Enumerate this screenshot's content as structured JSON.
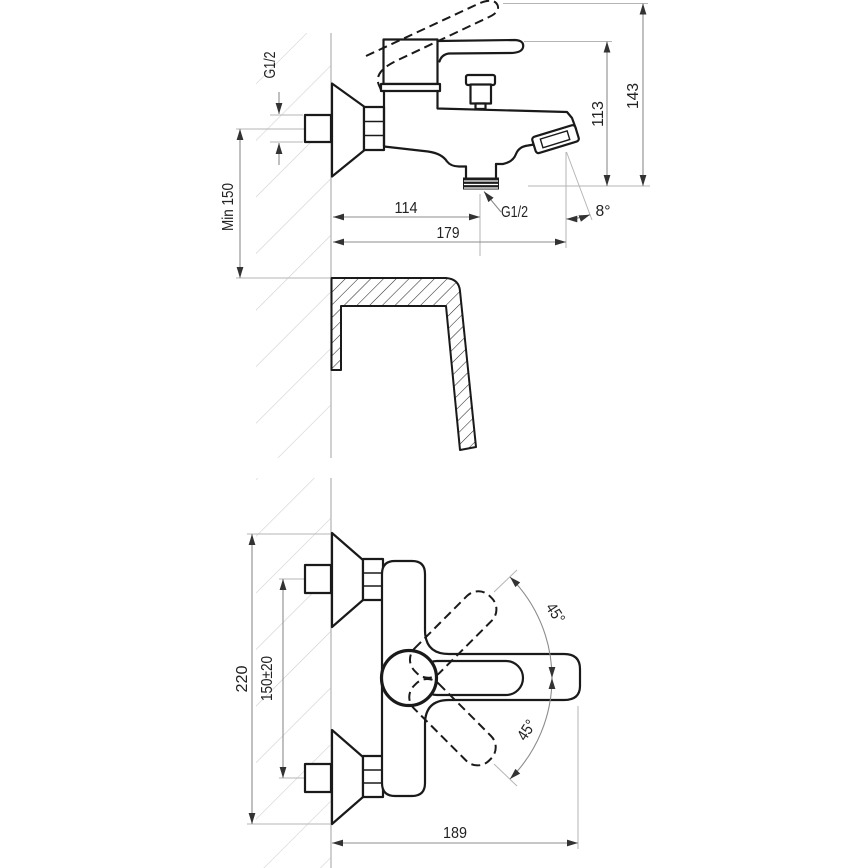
{
  "title": "Wall-mounted bath mixer dimensional drawing",
  "views": {
    "side": {
      "inlet_thread_label": "G1/2",
      "min_mount_height": "Min 150",
      "wall_to_shower_outlet": "114",
      "wall_to_spout_end": "179",
      "shower_outlet_thread": "G1/2",
      "spout_tilt_angle": "8°",
      "spout_height": "113",
      "overall_height": "143"
    },
    "front": {
      "flange_outer_span": "220",
      "inlet_center_distance": "150±20",
      "overall_width": "189",
      "handle_swing_upper": "45°",
      "handle_swing_lower": "45°"
    }
  },
  "colors": {
    "background": "#ffffff",
    "outline": "#1a1a1a",
    "dimension_line": "#8c8c8c",
    "reference_line": "#b5b5b5",
    "arrow": "#333333",
    "wall_line": "#bdbdbd",
    "wall_hatch": "#cfcfcf",
    "section_hatch": "#2a2a2a",
    "thread_fill": "#1d1d1d",
    "text": "#222222"
  }
}
